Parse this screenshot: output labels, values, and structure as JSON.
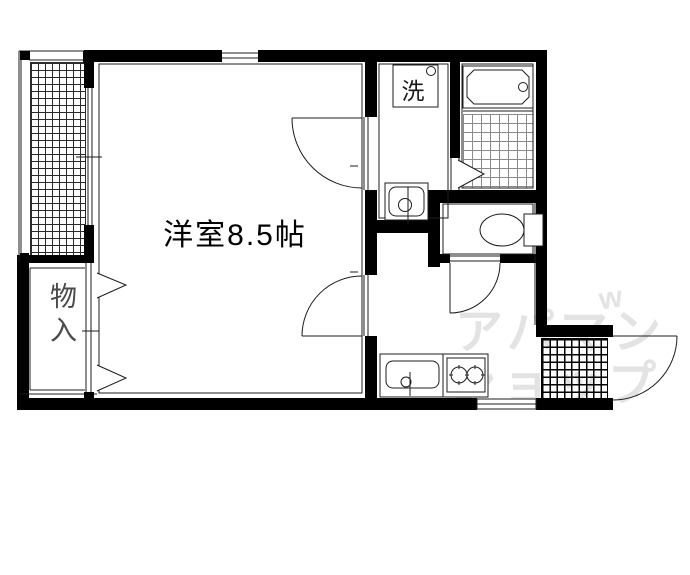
{
  "labels": {
    "room": "洋室8.5帖",
    "closet": "物入",
    "washer": "洗"
  },
  "watermark": {
    "line1": "アパマン",
    "line2": "ショップ",
    "mark": "w"
  },
  "colors": {
    "wall": "#000000",
    "line": "#1c1c1c",
    "watermark": "#e3e3e3"
  }
}
